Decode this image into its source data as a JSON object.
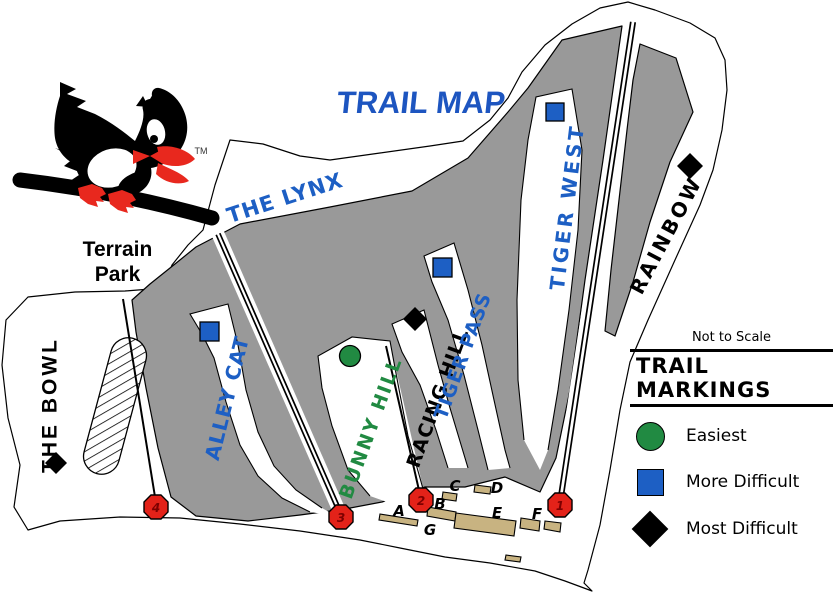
{
  "title": "TRAIL MAP",
  "trademark": "TM",
  "terrain_park_label": "Terrain Park",
  "not_to_scale": "Not to Scale",
  "legend": {
    "title": "TRAIL MARKINGS",
    "items": [
      {
        "label": "Easiest",
        "symbol": "green-circle"
      },
      {
        "label": "More Difficult",
        "symbol": "blue-square"
      },
      {
        "label": "Most Difficult",
        "symbol": "black-diamond"
      }
    ]
  },
  "trails": [
    {
      "name": "THE LYNX",
      "difficulty": "unmarked"
    },
    {
      "name": "TIGER WEST",
      "difficulty": "more-difficult"
    },
    {
      "name": "RAINBOW",
      "difficulty": "most-difficult"
    },
    {
      "name": "ALLEY CAT",
      "difficulty": "more-difficult"
    },
    {
      "name": "BUNNY HILL",
      "difficulty": "easiest"
    },
    {
      "name": "RACING HILL",
      "difficulty": "most-difficult"
    },
    {
      "name": "TIGER PASS",
      "difficulty": "more-difficult"
    },
    {
      "name": "THE BOWL",
      "difficulty": "most-difficult"
    }
  ],
  "lift_markers": [
    {
      "number": "1"
    },
    {
      "number": "2"
    },
    {
      "number": "3"
    },
    {
      "number": "4"
    }
  ],
  "base_buildings": [
    {
      "label": "A"
    },
    {
      "label": "B"
    },
    {
      "label": "C"
    },
    {
      "label": "D"
    },
    {
      "label": "E"
    },
    {
      "label": "F"
    },
    {
      "label": "G"
    }
  ],
  "colors": {
    "trail_blue": "#1d5fc4",
    "trail_green": "#218a42",
    "black": "#000000",
    "title_blue": "#1d55c0",
    "marker_red": "#e32219",
    "marker_number": "#7d0000",
    "forest_gray": "#999999",
    "building_tan": "#c8b381",
    "white": "#ffffff"
  }
}
